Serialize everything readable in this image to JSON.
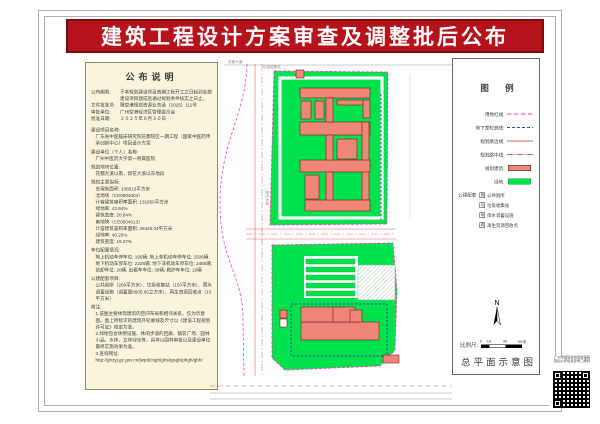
{
  "colors": {
    "banner_red": "#b5121b",
    "banner_border": "#7c0b0e",
    "panel_bg": "#f9f5dc",
    "frame_gray": "#b0b0b0",
    "text_dark": "#3c3c34",
    "site_green": "#00e24b",
    "building_fill": "#f0857a",
    "building_stroke": "#7a1f18",
    "boundary_magenta": "#ff3bd0",
    "underground_blue": "#3340d8",
    "road_red": "#e06060"
  },
  "title": "建筑工程设计方案审查及调整批后公布",
  "left_panel": {
    "header": "公布说明",
    "fields": [
      {
        "label": "公布期限:",
        "value": "于本规划建设项目首期工程开工之日起到全部建设项目建成后通过规划条件核实之日止。"
      },
      {
        "label": "文件批准号:",
        "value": "穗空港规划资源业务函〔2025〕111号"
      },
      {
        "label": "审批单位:",
        "value": "广州空港经济区管理委员会"
      },
      {
        "label": "批准日期:",
        "value": "２０２５年６月３０日"
      }
    ],
    "sections": [
      {
        "title": "建设项目名称:",
        "lines": [
          "广东省中医临床研究院花都院区一期工程（国家中医药传承创新中心）项目设计方案"
        ]
      },
      {
        "title": "建设单位（个人）名称:",
        "lines": [
          "广州中医药大学第一附属医院"
        ]
      },
      {
        "title": "规划地块位置:",
        "lines": [
          "花都大道以南，新花大道以东地段"
        ]
      },
      {
        "title": "规划主要指标:",
        "lines": [
          "总用地面积: 108513平方米",
          "北地块（CE0504004）",
          "计容建筑容积率面积: 131850平方米",
          "绿地率: 43.64%",
          "建筑密度: 20.84%",
          "南地块（CE0504013）",
          "计容建筑容积率面积: 49425.04平方米",
          "绿地率: 40.25%",
          "建筑密度: 15.27%"
        ]
      },
      {
        "title": "车位配置情况:",
        "lines": [
          "地上机动车停车位: 195辆; 地上非机动车停车位: 2506辆;",
          "地下机动车停车位: 2226辆; 地下非机动车停车位: 2485辆;",
          "装卸车位: 20辆; 出租车车位: 38辆; 救护车车位: 19辆"
        ]
      },
      {
        "title": "公建配套项目:",
        "lines": [
          "公共厕所（200平方米）、垃圾收集站（150平方米）、雨水调蓄设施（调蓄量6505.65立方米）、再生资源回收点（10平方米）"
        ]
      },
      {
        "title": "附注:",
        "lines": [
          "1.该图主要体现建筑的空间布局和相邻关系，仅为示意图。图上所标识的建筑外轮廓线及尺寸以《建设工程规划许可证》核定为准。",
          "2.绿地包含休憩设施、休闲步道的回廊、铺装广场、园林小品、水体、立体绿化等，具体以园林审批以及建设单位最终实施效果为准。",
          "3.查询网址:",
          "http://ghzyj.gz.gov.cn/jwpd/csgh/ghskgsgb/phgh/gbh/"
        ]
      }
    ]
  },
  "legend": {
    "header": "图 例",
    "line_items": [
      {
        "label": "用地红线:",
        "type": "magenta-dash"
      },
      {
        "label": "地下室轮廓线:",
        "type": "blue-dash"
      },
      {
        "label": "规划路边线:",
        "type": "red-line"
      },
      {
        "label": "规划路中线:",
        "type": "red-dashdot"
      },
      {
        "label": "规划建筑:",
        "type": "red-fill"
      },
      {
        "label": "绿地:",
        "type": "green-fill"
      }
    ],
    "public_label": "公建配套:",
    "public_items": [
      {
        "glyph": "厕",
        "label": "公共厕所"
      },
      {
        "glyph": "垃",
        "label": "垃圾收集站"
      },
      {
        "glyph": "雨",
        "label": "雨水调蓄设施"
      },
      {
        "glyph": "再",
        "label": "再生资源回收点"
      }
    ],
    "north_label": "N",
    "scale_label": "比例尺:",
    "scale_ticks": [
      "0",
      "10",
      "30",
      "50米"
    ],
    "plan_title": "总平面示意图"
  },
  "plan": {
    "labels": {
      "road_north": "花都大道",
      "road_west": "新花大道",
      "facility": "垃圾收集站"
    }
  },
  "qr": {
    "caption_line1": "广州市规划和自然资源局",
    "caption_line2": "批后公布信息查询二维码"
  }
}
